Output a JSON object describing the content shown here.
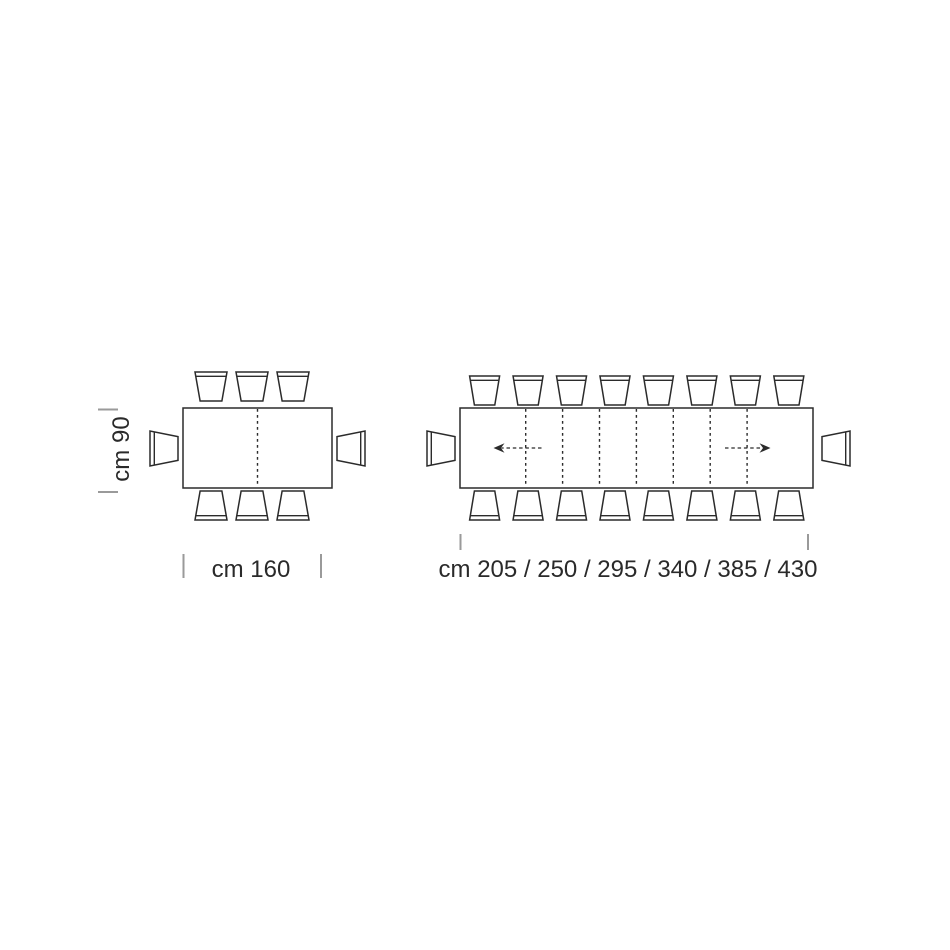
{
  "colors": {
    "line": "#2b2b2b",
    "tick": "#9a9a9a",
    "text": "#2a2a2a",
    "background": "#ffffff"
  },
  "closed_table": {
    "depth_label": "cm 90",
    "width_label": "cm 160",
    "seats": {
      "top": 3,
      "bottom": 3,
      "left": 1,
      "right": 1
    },
    "leaf_lines": 1
  },
  "extended_table": {
    "lengths_label": "cm 205 / 250 / 295 / 340 / 385 / 430",
    "seats": {
      "top": 8,
      "bottom": 8,
      "left": 1,
      "right": 1
    },
    "leaf_lines": 7,
    "arrows": [
      "left",
      "right"
    ]
  }
}
